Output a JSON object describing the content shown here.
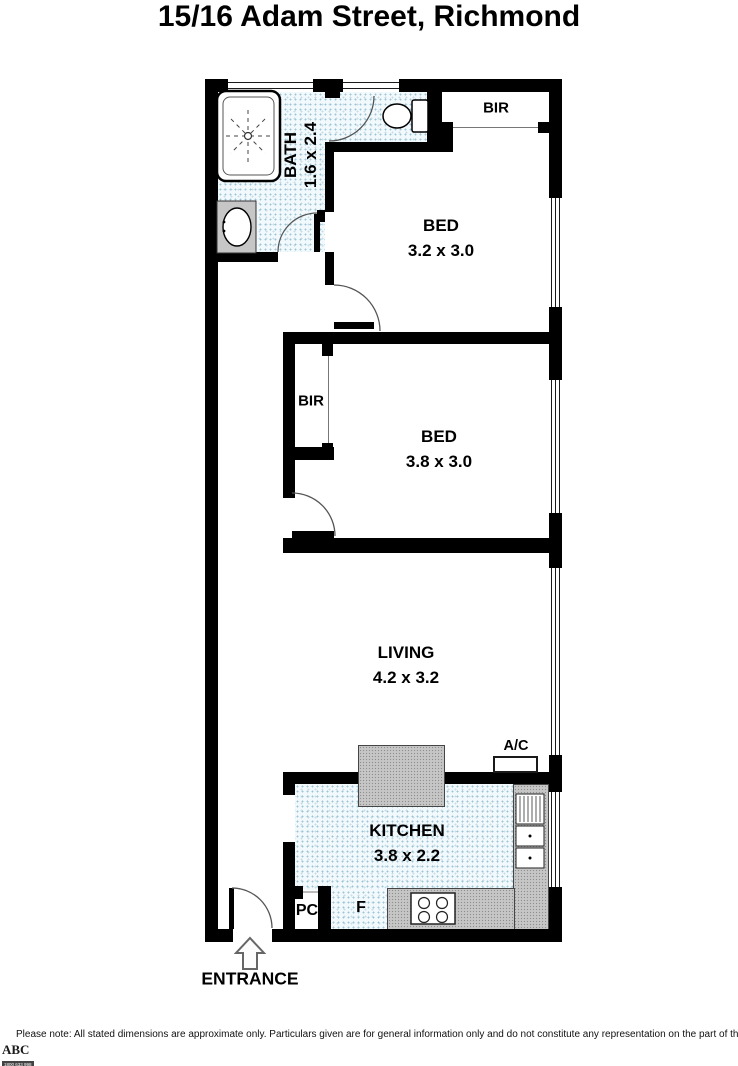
{
  "title": "15/16 Adam Street, Richmond",
  "rooms": {
    "bath": {
      "name": "BATH",
      "dims": "1.6 x 2.4"
    },
    "bed1": {
      "name": "BED",
      "dims": "3.2 x 3.0"
    },
    "bed2": {
      "name": "BED",
      "dims": "3.8 x 3.0"
    },
    "living": {
      "name": "LIVING",
      "dims": "4.2 x 3.2"
    },
    "kitchen": {
      "name": "KITCHEN",
      "dims": "3.8 x 2.2"
    }
  },
  "features": {
    "bir_bed1": "BIR",
    "bir_bed2": "BIR",
    "ac": "A/C",
    "pc": "PC",
    "fridge": "F",
    "entrance": "ENTRANCE"
  },
  "footer": {
    "disclaimer": "Please note: All stated dimensions are approximate only. Particulars given are for general information only and do not constitute any representation on the part of the vendor or agent."
  },
  "logo": {
    "name": "ABC",
    "phone": "1800 633 998",
    "website": "www.abcphotosigns.com.au"
  },
  "colors": {
    "wall": "#000000",
    "floor_stipple": "#f2f9fc",
    "counter": "#c6c6c6"
  }
}
